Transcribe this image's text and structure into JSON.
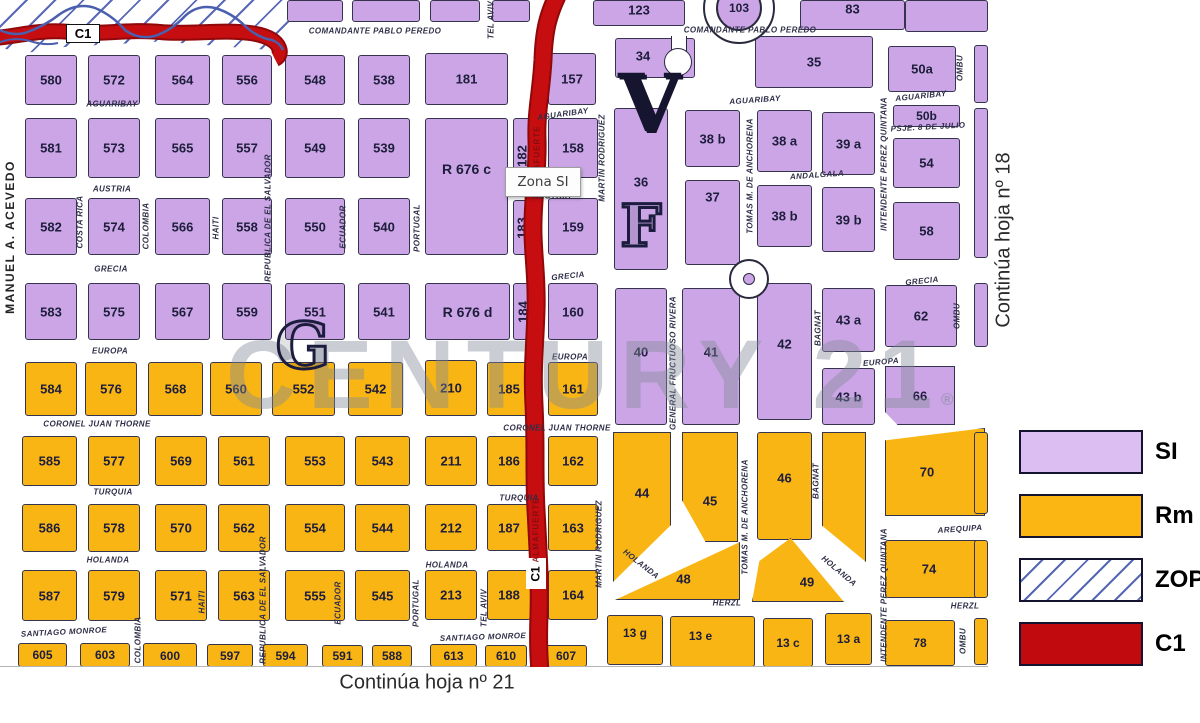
{
  "labels": {
    "tooltip": "Zona SI",
    "c1_badge": "C1",
    "continua_right": "Continúa hoja nº 18",
    "continua_bottom": "Continúa hoja nº 21",
    "watermark": "CENTURY 21",
    "registered": "®",
    "roundabout_number": "103",
    "letter_g": "G",
    "letter_v": "V",
    "letter_f": "F"
  },
  "colors": {
    "si_block": "#CBA5E5",
    "rm_block": "#F9B513",
    "legend_si": "#DCBEF3",
    "legend_rm": "#FBB614",
    "legend_c1": "#C00A0E",
    "road": "#C60D10",
    "road_edge": "#90080A",
    "hatch_blue": "#5A6AB8",
    "stream_blue": "#4A5FAE"
  },
  "legend": {
    "items": [
      {
        "label": "SI",
        "key": "si"
      },
      {
        "label": "Rm",
        "key": "rm"
      },
      {
        "label": "ZOP",
        "key": "zop"
      },
      {
        "label": "C1",
        "key": "c1"
      }
    ]
  },
  "road_inscriptions": [
    {
      "t": "ALMAFUERTE",
      "x": 537,
      "y": 158
    },
    {
      "t": "ALMAFUERTE",
      "x": 536,
      "y": 530
    }
  ],
  "streets_h": [
    {
      "t": "COMANDANTE PABLO PEREDO",
      "x": 375,
      "y": 31
    },
    {
      "t": "COMANDANTE PABLO PEREDO",
      "x": 750,
      "y": 30
    },
    {
      "t": "AGUARIBAY",
      "x": 112,
      "y": 104
    },
    {
      "t": "AGUARIBAY",
      "x": 563,
      "y": 114,
      "r": -8
    },
    {
      "t": "AGUARIBAY",
      "x": 755,
      "y": 100,
      "r": -4
    },
    {
      "t": "AGUARIBAY",
      "x": 921,
      "y": 96,
      "r": -6
    },
    {
      "t": "AUSTRIA",
      "x": 112,
      "y": 189
    },
    {
      "t": "AUSTRIA",
      "x": 552,
      "y": 196
    },
    {
      "t": "GRECIA",
      "x": 111,
      "y": 269
    },
    {
      "t": "GRECIA",
      "x": 568,
      "y": 276,
      "r": -6
    },
    {
      "t": "GRECIA",
      "x": 922,
      "y": 281,
      "r": -6
    },
    {
      "t": "EUROPA",
      "x": 110,
      "y": 351
    },
    {
      "t": "EUROPA",
      "x": 570,
      "y": 357
    },
    {
      "t": "EUROPA",
      "x": 881,
      "y": 362,
      "r": -5
    },
    {
      "t": "CORONEL JUAN THORNE",
      "x": 97,
      "y": 424
    },
    {
      "t": "CORONEL JUAN THORNE",
      "x": 557,
      "y": 428
    },
    {
      "t": "TURQUIA",
      "x": 113,
      "y": 492
    },
    {
      "t": "TURQUIA",
      "x": 519,
      "y": 498
    },
    {
      "t": "HOLANDA",
      "x": 108,
      "y": 560
    },
    {
      "t": "HOLANDA",
      "x": 447,
      "y": 565
    },
    {
      "t": "HOLANDA",
      "x": 641,
      "y": 564,
      "r": 38
    },
    {
      "t": "HOLANDA",
      "x": 839,
      "y": 571,
      "r": 40
    },
    {
      "t": "SANTIAGO MONROE",
      "x": 64,
      "y": 632,
      "r": -3
    },
    {
      "t": "SANTIAGO MONROE",
      "x": 483,
      "y": 637,
      "r": -2
    },
    {
      "t": "HERZL",
      "x": 727,
      "y": 603
    },
    {
      "t": "HERZL",
      "x": 965,
      "y": 606
    },
    {
      "t": "AREQUIPA",
      "x": 960,
      "y": 529,
      "r": -4
    },
    {
      "t": "PSJE. 8 DE JULIO",
      "x": 928,
      "y": 127,
      "r": -3
    },
    {
      "t": "ANDALGALA",
      "x": 817,
      "y": 175,
      "r": -4
    }
  ],
  "streets_v": [
    {
      "t": "MANUEL A. ACEVEDO",
      "x": 10,
      "y": 237,
      "edge": true
    },
    {
      "t": "COSTA RICA",
      "x": 80,
      "y": 222
    },
    {
      "t": "COLOMBIA",
      "x": 146,
      "y": 226
    },
    {
      "t": "COLOMBIA",
      "x": 138,
      "y": 640
    },
    {
      "t": "HAITI",
      "x": 216,
      "y": 228
    },
    {
      "t": "HAITI",
      "x": 202,
      "y": 602
    },
    {
      "t": "REPUBLICA DE EL SALVADOR",
      "x": 268,
      "y": 218
    },
    {
      "t": "REPUBLICA DE EL SALVADOR",
      "x": 263,
      "y": 600
    },
    {
      "t": "ECUADOR",
      "x": 343,
      "y": 227
    },
    {
      "t": "ECUADOR",
      "x": 338,
      "y": 603
    },
    {
      "t": "PORTUGAL",
      "x": 417,
      "y": 228
    },
    {
      "t": "PORTUGAL",
      "x": 416,
      "y": 603
    },
    {
      "t": "TEL AVIV",
      "x": 491,
      "y": 20
    },
    {
      "t": "TEL AVIV",
      "x": 484,
      "y": 608
    },
    {
      "t": "MARTIN RODRIGUEZ",
      "x": 602,
      "y": 158
    },
    {
      "t": "MARTIN RODRIGUEZ",
      "x": 599,
      "y": 544
    },
    {
      "t": "TOMAS M. DE ANCHORENA",
      "x": 750,
      "y": 176
    },
    {
      "t": "TOMAS M. DE ANCHORENA",
      "x": 745,
      "y": 517
    },
    {
      "t": "GENERAL FRUCTUOSO RIVERA",
      "x": 673,
      "y": 363
    },
    {
      "t": "BAGNAT",
      "x": 818,
      "y": 328
    },
    {
      "t": "BAGNAT",
      "x": 816,
      "y": 481
    },
    {
      "t": "INTENDENTE PEREZ QUINTANA",
      "x": 884,
      "y": 164
    },
    {
      "t": "INTENDENTE PEREZ QUINTANA",
      "x": 884,
      "y": 595
    },
    {
      "t": "OMBU",
      "x": 960,
      "y": 68
    },
    {
      "t": "OMBU",
      "x": 957,
      "y": 316
    },
    {
      "t": "OMBU",
      "x": 963,
      "y": 641
    }
  ],
  "blocks": [
    {
      "x": 287,
      "y": 0,
      "w": 56,
      "h": 22,
      "z": "si"
    },
    {
      "x": 352,
      "y": 0,
      "w": 68,
      "h": 22,
      "z": "si"
    },
    {
      "x": 430,
      "y": 0,
      "w": 50,
      "h": 22,
      "z": "si"
    },
    {
      "x": 492,
      "y": 0,
      "w": 38,
      "h": 22,
      "z": "si"
    },
    {
      "n": "123",
      "x": 593,
      "y": 0,
      "w": 92,
      "h": 26,
      "z": "si",
      "dy": -3
    },
    {
      "n": "83",
      "x": 800,
      "y": 0,
      "w": 105,
      "h": 30,
      "z": "si",
      "dy": -6
    },
    {
      "x": 905,
      "y": 0,
      "w": 83,
      "h": 32,
      "z": "si"
    },
    {
      "n": "580",
      "x": 25,
      "y": 55,
      "w": 52,
      "h": 50,
      "z": "si"
    },
    {
      "n": "572",
      "x": 88,
      "y": 55,
      "w": 52,
      "h": 50,
      "z": "si"
    },
    {
      "n": "564",
      "x": 155,
      "y": 55,
      "w": 55,
      "h": 50,
      "z": "si"
    },
    {
      "n": "556",
      "x": 222,
      "y": 55,
      "w": 50,
      "h": 50,
      "z": "si"
    },
    {
      "n": "548",
      "x": 285,
      "y": 55,
      "w": 60,
      "h": 50,
      "z": "si"
    },
    {
      "n": "538",
      "x": 358,
      "y": 55,
      "w": 52,
      "h": 50,
      "z": "si"
    },
    {
      "n": "181",
      "x": 425,
      "y": 53,
      "w": 83,
      "h": 52,
      "z": "si"
    },
    {
      "n": "157",
      "x": 548,
      "y": 53,
      "w": 48,
      "h": 52,
      "z": "si"
    },
    {
      "n": "34",
      "x": 615,
      "y": 38,
      "w": 80,
      "h": 40,
      "z": "si",
      "dx": -12,
      "dy": -2
    },
    {
      "n": "35",
      "x": 755,
      "y": 36,
      "w": 118,
      "h": 52,
      "z": "si"
    },
    {
      "n": "50a",
      "x": 888,
      "y": 46,
      "w": 68,
      "h": 46,
      "z": "si"
    },
    {
      "x": 974,
      "y": 45,
      "w": 14,
      "h": 58,
      "z": "si"
    },
    {
      "n": "581",
      "x": 25,
      "y": 118,
      "w": 52,
      "h": 60,
      "z": "si"
    },
    {
      "n": "573",
      "x": 88,
      "y": 118,
      "w": 52,
      "h": 60,
      "z": "si"
    },
    {
      "n": "565",
      "x": 155,
      "y": 118,
      "w": 55,
      "h": 60,
      "z": "si"
    },
    {
      "n": "557",
      "x": 222,
      "y": 118,
      "w": 50,
      "h": 60,
      "z": "si"
    },
    {
      "n": "549",
      "x": 285,
      "y": 118,
      "w": 60,
      "h": 60,
      "z": "si"
    },
    {
      "n": "539",
      "x": 358,
      "y": 118,
      "w": 52,
      "h": 60,
      "z": "si"
    },
    {
      "n": "R 676 c",
      "x": 425,
      "y": 118,
      "w": 83,
      "h": 137,
      "z": "si",
      "fs": 14,
      "dy": -18
    },
    {
      "n": "182",
      "x": 513,
      "y": 118,
      "w": 18,
      "h": 75,
      "z": "si",
      "v": true
    },
    {
      "n": "158",
      "x": 548,
      "y": 118,
      "w": 50,
      "h": 60,
      "z": "si"
    },
    {
      "n": "36",
      "x": 614,
      "y": 108,
      "w": 54,
      "h": 162,
      "z": "si",
      "dy": -7
    },
    {
      "n": "38 b",
      "x": 685,
      "y": 110,
      "w": 55,
      "h": 57,
      "z": "si"
    },
    {
      "n": "38 a",
      "x": 757,
      "y": 110,
      "w": 55,
      "h": 62,
      "z": "si"
    },
    {
      "n": "39 a",
      "x": 822,
      "y": 112,
      "w": 53,
      "h": 63,
      "z": "si"
    },
    {
      "n": "50b",
      "x": 893,
      "y": 105,
      "w": 67,
      "h": 22,
      "z": "si",
      "fs": 12
    },
    {
      "n": "54",
      "x": 893,
      "y": 138,
      "w": 67,
      "h": 50,
      "z": "si"
    },
    {
      "x": 974,
      "y": 108,
      "w": 14,
      "h": 150,
      "z": "si"
    },
    {
      "n": "582",
      "x": 25,
      "y": 198,
      "w": 52,
      "h": 57,
      "z": "si"
    },
    {
      "n": "574",
      "x": 88,
      "y": 198,
      "w": 52,
      "h": 57,
      "z": "si"
    },
    {
      "n": "566",
      "x": 155,
      "y": 198,
      "w": 55,
      "h": 57,
      "z": "si"
    },
    {
      "n": "558",
      "x": 222,
      "y": 198,
      "w": 50,
      "h": 57,
      "z": "si"
    },
    {
      "n": "550",
      "x": 285,
      "y": 198,
      "w": 60,
      "h": 57,
      "z": "si"
    },
    {
      "n": "540",
      "x": 358,
      "y": 198,
      "w": 52,
      "h": 57,
      "z": "si"
    },
    {
      "n": "183",
      "x": 513,
      "y": 200,
      "w": 18,
      "h": 55,
      "z": "si",
      "v": true
    },
    {
      "n": "159",
      "x": 548,
      "y": 198,
      "w": 50,
      "h": 57,
      "z": "si"
    },
    {
      "n": "37",
      "x": 685,
      "y": 180,
      "w": 55,
      "h": 85,
      "z": "si",
      "dy": -26
    },
    {
      "n": "38 b",
      "x": 757,
      "y": 185,
      "w": 55,
      "h": 62,
      "z": "si"
    },
    {
      "n": "39 b",
      "x": 822,
      "y": 187,
      "w": 53,
      "h": 65,
      "z": "si"
    },
    {
      "n": "58",
      "x": 893,
      "y": 202,
      "w": 67,
      "h": 58,
      "z": "si"
    },
    {
      "n": "583",
      "x": 25,
      "y": 283,
      "w": 52,
      "h": 57,
      "z": "si"
    },
    {
      "n": "575",
      "x": 88,
      "y": 283,
      "w": 52,
      "h": 57,
      "z": "si"
    },
    {
      "n": "567",
      "x": 155,
      "y": 283,
      "w": 55,
      "h": 57,
      "z": "si"
    },
    {
      "n": "559",
      "x": 222,
      "y": 283,
      "w": 50,
      "h": 57,
      "z": "si"
    },
    {
      "n": "551",
      "x": 285,
      "y": 283,
      "w": 60,
      "h": 57,
      "z": "si"
    },
    {
      "n": "541",
      "x": 358,
      "y": 283,
      "w": 52,
      "h": 57,
      "z": "si"
    },
    {
      "n": "R 676 d",
      "x": 425,
      "y": 283,
      "w": 85,
      "h": 57,
      "z": "si",
      "fs": 14
    },
    {
      "n": "184",
      "x": 513,
      "y": 283,
      "w": 20,
      "h": 57,
      "z": "si",
      "v": true
    },
    {
      "n": "160",
      "x": 548,
      "y": 283,
      "w": 50,
      "h": 57,
      "z": "si"
    },
    {
      "n": "40",
      "x": 615,
      "y": 288,
      "w": 52,
      "h": 137,
      "z": "si",
      "dy": -5
    },
    {
      "n": "41",
      "x": 682,
      "y": 288,
      "w": 58,
      "h": 137,
      "z": "si",
      "dy": -5
    },
    {
      "n": "42",
      "x": 757,
      "y": 283,
      "w": 55,
      "h": 137,
      "z": "si",
      "dy": -8
    },
    {
      "n": "43 a",
      "x": 822,
      "y": 288,
      "w": 53,
      "h": 64,
      "z": "si"
    },
    {
      "n": "62",
      "x": 885,
      "y": 285,
      "w": 72,
      "h": 62,
      "z": "si"
    },
    {
      "x": 974,
      "y": 283,
      "w": 14,
      "h": 64,
      "z": "si"
    },
    {
      "n": "43 b",
      "x": 822,
      "y": 368,
      "w": 53,
      "h": 57,
      "z": "si"
    },
    {
      "n": "66",
      "x": 885,
      "y": 366,
      "w": 70,
      "h": 59,
      "z": "si",
      "clip": "polygon(0 0,100% 0,100% 100%,18% 100%,0 78%)"
    },
    {
      "n": "584",
      "x": 25,
      "y": 362,
      "w": 52,
      "h": 54,
      "z": "rm"
    },
    {
      "n": "576",
      "x": 85,
      "y": 362,
      "w": 52,
      "h": 54,
      "z": "rm"
    },
    {
      "n": "568",
      "x": 148,
      "y": 362,
      "w": 55,
      "h": 54,
      "z": "rm"
    },
    {
      "n": "560",
      "x": 210,
      "y": 362,
      "w": 52,
      "h": 54,
      "z": "rm"
    },
    {
      "n": "552",
      "x": 272,
      "y": 362,
      "w": 63,
      "h": 54,
      "z": "rm"
    },
    {
      "n": "542",
      "x": 348,
      "y": 362,
      "w": 55,
      "h": 54,
      "z": "rm"
    },
    {
      "n": "210",
      "x": 425,
      "y": 360,
      "w": 52,
      "h": 56,
      "z": "rm"
    },
    {
      "n": "185",
      "x": 487,
      "y": 362,
      "w": 44,
      "h": 54,
      "z": "rm"
    },
    {
      "n": "161",
      "x": 548,
      "y": 362,
      "w": 50,
      "h": 54,
      "z": "rm"
    },
    {
      "n": "585",
      "x": 22,
      "y": 436,
      "w": 55,
      "h": 50,
      "z": "rm"
    },
    {
      "n": "577",
      "x": 88,
      "y": 436,
      "w": 52,
      "h": 50,
      "z": "rm"
    },
    {
      "n": "569",
      "x": 155,
      "y": 436,
      "w": 52,
      "h": 50,
      "z": "rm"
    },
    {
      "n": "561",
      "x": 218,
      "y": 436,
      "w": 52,
      "h": 50,
      "z": "rm"
    },
    {
      "n": "553",
      "x": 285,
      "y": 436,
      "w": 60,
      "h": 50,
      "z": "rm"
    },
    {
      "n": "543",
      "x": 355,
      "y": 436,
      "w": 55,
      "h": 50,
      "z": "rm"
    },
    {
      "n": "211",
      "x": 425,
      "y": 436,
      "w": 52,
      "h": 50,
      "z": "rm"
    },
    {
      "n": "186",
      "x": 487,
      "y": 436,
      "w": 44,
      "h": 50,
      "z": "rm"
    },
    {
      "n": "162",
      "x": 548,
      "y": 436,
      "w": 50,
      "h": 50,
      "z": "rm"
    },
    {
      "n": "44",
      "x": 613,
      "y": 432,
      "w": 58,
      "h": 150,
      "z": "rm",
      "clip": "polygon(0 0,100% 0,100% 62%,0 100%)",
      "dy": -14
    },
    {
      "n": "45",
      "x": 682,
      "y": 432,
      "w": 56,
      "h": 110,
      "z": "rm",
      "clip": "polygon(0 0,100% 0,100% 100%,42% 100%,0 62%)",
      "dy": 14
    },
    {
      "n": "46",
      "x": 757,
      "y": 432,
      "w": 55,
      "h": 108,
      "z": "rm",
      "dy": -8
    },
    {
      "x": 822,
      "y": 432,
      "w": 44,
      "h": 130,
      "z": "rm",
      "clip": "polygon(0 0,100% 0,100% 100%,0 72%)"
    },
    {
      "n": "70",
      "x": 885,
      "y": 428,
      "w": 100,
      "h": 88,
      "z": "rm",
      "clip": "polygon(0 14%,100% 0,100% 100%,0 100%)",
      "dx": -8
    },
    {
      "n": "586",
      "x": 22,
      "y": 504,
      "w": 55,
      "h": 48,
      "z": "rm"
    },
    {
      "n": "578",
      "x": 88,
      "y": 504,
      "w": 52,
      "h": 48,
      "z": "rm"
    },
    {
      "n": "570",
      "x": 155,
      "y": 504,
      "w": 52,
      "h": 48,
      "z": "rm"
    },
    {
      "n": "562",
      "x": 218,
      "y": 504,
      "w": 52,
      "h": 48,
      "z": "rm"
    },
    {
      "n": "554",
      "x": 285,
      "y": 504,
      "w": 60,
      "h": 48,
      "z": "rm"
    },
    {
      "n": "544",
      "x": 355,
      "y": 504,
      "w": 55,
      "h": 48,
      "z": "rm"
    },
    {
      "n": "212",
      "x": 425,
      "y": 504,
      "w": 52,
      "h": 47,
      "z": "rm"
    },
    {
      "n": "187",
      "x": 487,
      "y": 504,
      "w": 44,
      "h": 47,
      "z": "rm"
    },
    {
      "n": "163",
      "x": 548,
      "y": 504,
      "w": 50,
      "h": 47,
      "z": "rm"
    },
    {
      "n": "48",
      "x": 615,
      "y": 542,
      "w": 125,
      "h": 58,
      "z": "rm",
      "clip": "polygon(100% 0,100% 100%,0 100%)",
      "dx": 6,
      "dy": 8
    },
    {
      "n": "49",
      "x": 752,
      "y": 538,
      "w": 92,
      "h": 64,
      "z": "rm",
      "clip": "polygon(8% 36%,42% 0,100% 100%,0 100%)",
      "dx": 9,
      "dy": 12
    },
    {
      "n": "74",
      "x": 885,
      "y": 540,
      "w": 100,
      "h": 58,
      "z": "rm",
      "dx": -6
    },
    {
      "n": "587",
      "x": 22,
      "y": 570,
      "w": 55,
      "h": 51,
      "z": "rm"
    },
    {
      "n": "579",
      "x": 88,
      "y": 570,
      "w": 52,
      "h": 51,
      "z": "rm"
    },
    {
      "n": "571",
      "x": 155,
      "y": 570,
      "w": 52,
      "h": 51,
      "z": "rm"
    },
    {
      "n": "563",
      "x": 218,
      "y": 570,
      "w": 52,
      "h": 51,
      "z": "rm"
    },
    {
      "n": "555",
      "x": 285,
      "y": 570,
      "w": 60,
      "h": 51,
      "z": "rm"
    },
    {
      "n": "545",
      "x": 355,
      "y": 570,
      "w": 55,
      "h": 51,
      "z": "rm"
    },
    {
      "n": "213",
      "x": 425,
      "y": 570,
      "w": 52,
      "h": 50,
      "z": "rm"
    },
    {
      "n": "188",
      "x": 487,
      "y": 570,
      "w": 44,
      "h": 50,
      "z": "rm"
    },
    {
      "n": "164",
      "x": 548,
      "y": 570,
      "w": 50,
      "h": 50,
      "z": "rm"
    },
    {
      "x": 974,
      "y": 432,
      "w": 14,
      "h": 82,
      "z": "rm"
    },
    {
      "x": 974,
      "y": 540,
      "w": 14,
      "h": 58,
      "z": "rm"
    },
    {
      "n": "605",
      "x": 18,
      "y": 643,
      "w": 49,
      "h": 24,
      "z": "rm",
      "fs": 12
    },
    {
      "n": "603",
      "x": 80,
      "y": 643,
      "w": 50,
      "h": 24,
      "z": "rm",
      "fs": 12
    },
    {
      "n": "600",
      "x": 143,
      "y": 643,
      "w": 54,
      "h": 25,
      "z": "rm",
      "fs": 12
    },
    {
      "n": "597",
      "x": 207,
      "y": 644,
      "w": 46,
      "h": 23,
      "z": "rm",
      "fs": 12
    },
    {
      "n": "594",
      "x": 263,
      "y": 644,
      "w": 45,
      "h": 23,
      "z": "rm",
      "fs": 12
    },
    {
      "n": "591",
      "x": 322,
      "y": 645,
      "w": 41,
      "h": 22,
      "z": "rm",
      "fs": 12
    },
    {
      "n": "588",
      "x": 372,
      "y": 645,
      "w": 40,
      "h": 22,
      "z": "rm",
      "fs": 12
    },
    {
      "n": "613",
      "x": 430,
      "y": 644,
      "w": 47,
      "h": 23,
      "z": "rm",
      "fs": 12
    },
    {
      "n": "610",
      "x": 485,
      "y": 645,
      "w": 42,
      "h": 22,
      "z": "rm",
      "fs": 12
    },
    {
      "n": "607",
      "x": 545,
      "y": 645,
      "w": 42,
      "h": 22,
      "z": "rm",
      "fs": 12
    },
    {
      "n": "13 g",
      "x": 607,
      "y": 615,
      "w": 56,
      "h": 50,
      "z": "rm",
      "fs": 12,
      "dy": -7
    },
    {
      "n": "13 e",
      "x": 670,
      "y": 616,
      "w": 85,
      "h": 51,
      "z": "rm",
      "fs": 12,
      "dx": -12,
      "dy": -6
    },
    {
      "n": "13 c",
      "x": 763,
      "y": 618,
      "w": 50,
      "h": 49,
      "z": "rm",
      "fs": 12
    },
    {
      "n": "13 a",
      "x": 825,
      "y": 613,
      "w": 47,
      "h": 52,
      "z": "rm",
      "fs": 12
    },
    {
      "n": "78",
      "x": 885,
      "y": 620,
      "w": 70,
      "h": 46,
      "z": "rm",
      "fs": 12
    },
    {
      "x": 974,
      "y": 618,
      "w": 14,
      "h": 47,
      "z": "rm"
    }
  ]
}
